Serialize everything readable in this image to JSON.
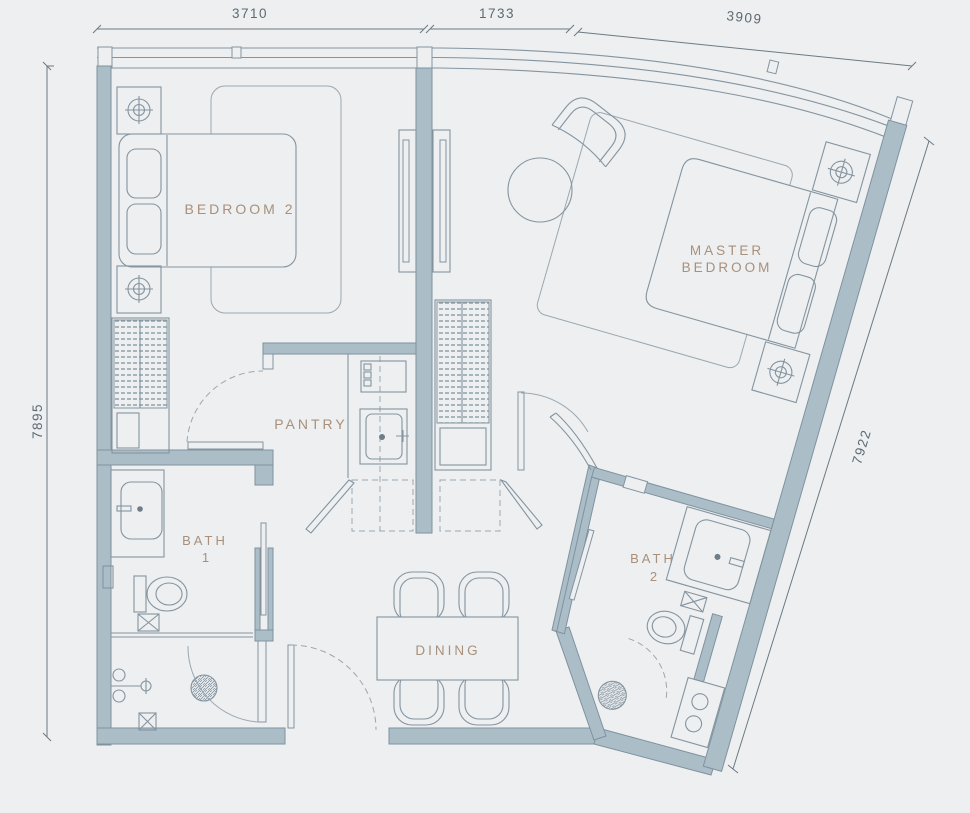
{
  "plan": {
    "title": "2-bedroom unit floor plan",
    "rooms": {
      "bedroom2": {
        "label": "BEDROOM 2"
      },
      "master": {
        "line1": "MASTER",
        "line2": "BEDROOM"
      },
      "pantry": {
        "label": "PANTRY"
      },
      "bath1": {
        "line1": "BATH",
        "line2": "1"
      },
      "bath2": {
        "line1": "BATH",
        "line2": "2"
      },
      "dining": {
        "label": "DINING"
      }
    },
    "dimensions": {
      "top_left": "3710",
      "top_middle": "1733",
      "top_right": "3909",
      "left": "7895",
      "right": "7922"
    },
    "colors": {
      "background": "#edeff0",
      "wall_fill": "#abbec8",
      "wall_stroke": "#7f929e",
      "line": "#8494a0",
      "room_label": "#a8907c",
      "dimension_text": "#5d6a73"
    },
    "fixtures": [
      "double-bed-bedroom2",
      "double-bed-master",
      "nightstand-with-light-x4",
      "wardrobe-bedroom2",
      "wardrobe-hall",
      "sliding-mirror-panels",
      "kitchen-cooktop",
      "kitchen-sink",
      "base-cabinets-open",
      "bath1-sink",
      "bath1-toilet",
      "bath1-shower-drain",
      "bath2-sink",
      "bath2-toilet",
      "bath2-shower-drain",
      "washer",
      "dining-table",
      "dining-chairs-x4",
      "armchair",
      "round-side-table",
      "entry-door",
      "interior-doors"
    ]
  }
}
